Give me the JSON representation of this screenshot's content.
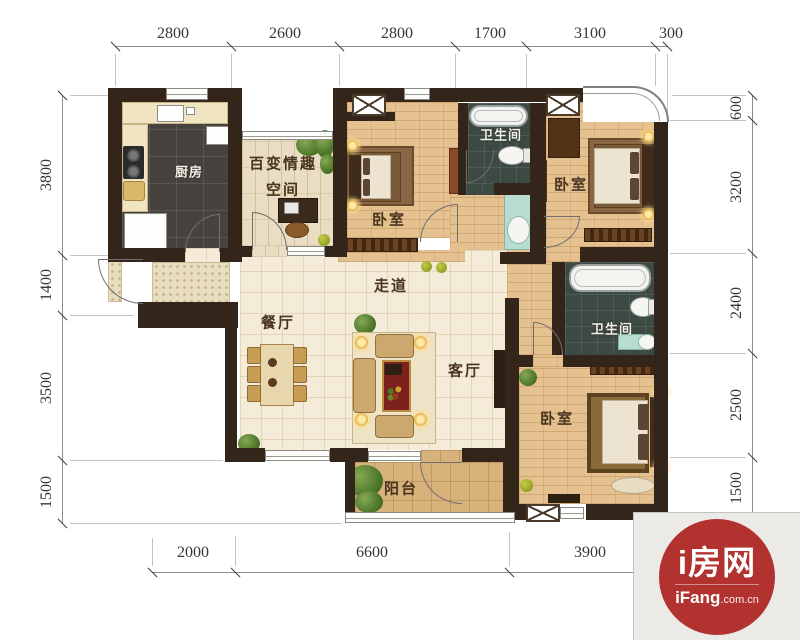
{
  "rooms": {
    "kitchen": "厨房",
    "flex_space_line1": "百变情趣",
    "flex_space_line2": "空间",
    "bedroom_top": "卧室",
    "bedroom_right": "卧室",
    "bedroom_bottom": "卧室",
    "bathroom_top": "卫生间",
    "bathroom_right": "卫生间",
    "corridor": "走道",
    "dining": "餐厅",
    "living": "客厅",
    "balcony": "阳台"
  },
  "dims": {
    "top": [
      "2800",
      "2600",
      "2800",
      "1700",
      "3100",
      "300"
    ],
    "left": [
      "3800",
      "1400",
      "3500",
      "1500"
    ],
    "right": [
      "600",
      "3200",
      "2400",
      "2500",
      "1500"
    ],
    "bottom": [
      "2000",
      "6600",
      "3900"
    ]
  },
  "logo": {
    "title": "i房网",
    "brand": "iFang",
    "suffix": ".com.cn"
  },
  "colors": {
    "wall": "#34251a",
    "wood_floor": "#e6c190",
    "cream_tile": "#f4ecd9",
    "dark_tile": "#46423d",
    "bath_tile": "#3d4a44",
    "balcony_tile": "#d8b27b",
    "brand_red": "#b23230"
  }
}
